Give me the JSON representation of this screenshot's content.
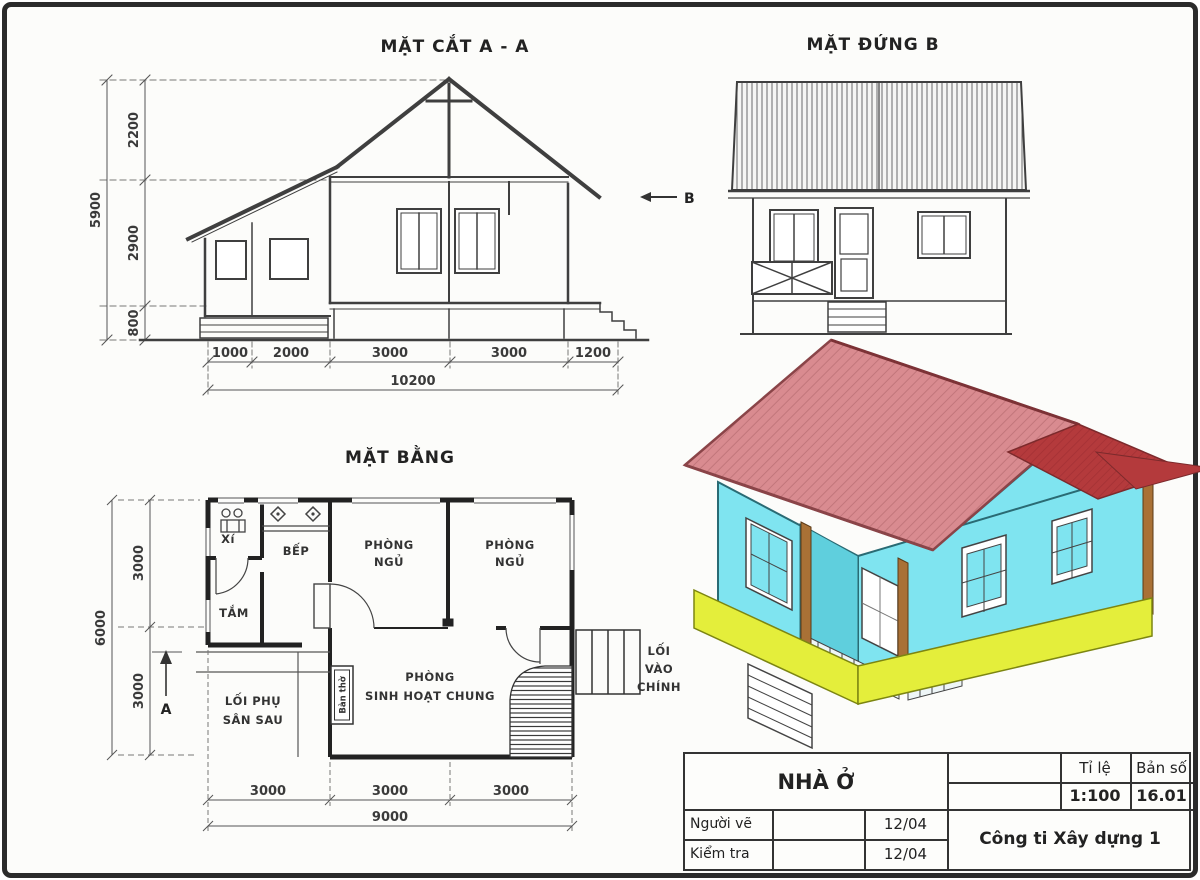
{
  "section": {
    "title": "MẶT CẮT A - A",
    "dim_total_left": "5900",
    "dim_left_segments": [
      "2200",
      "2900",
      "800"
    ],
    "dim_bottom_segments": [
      "1000",
      "2000",
      "3000",
      "3000",
      "1200"
    ],
    "dim_bottom_total": "10200",
    "view_marker": "B"
  },
  "elevation": {
    "title": "MẶT ĐỨNG B"
  },
  "plan": {
    "title": "MẶT BẰNG",
    "room_toilet": "Xí",
    "room_kitchen": "BẾP",
    "room_bedroom1_line1": "PHÒNG",
    "room_bedroom1_line2": "NGỦ",
    "room_bedroom2_line1": "PHÒNG",
    "room_bedroom2_line2": "NGỦ",
    "room_bath": "TẮM",
    "room_living_line1": "PHÒNG",
    "room_living_line2": "SINH HOẠT CHUNG",
    "altar": "Bàn thờ",
    "side_path_line1": "LỐI PHỤ",
    "side_path_line2": "SÂN SAU",
    "entry_line1": "LỐI",
    "entry_line2": "VÀO",
    "entry_line3": "CHÍNH",
    "dim_total_left": "6000",
    "dim_left_segments": [
      "3000",
      "3000"
    ],
    "dim_bottom_segments": [
      "3000",
      "3000",
      "3000"
    ],
    "dim_bottom_total": "9000",
    "section_marker": "A"
  },
  "title_block": {
    "project": "NHÀ Ở",
    "scale_label": "Tỉ lệ",
    "scale_value": "1:100",
    "sheet_label": "Bản số",
    "sheet_value": "16.01",
    "drawn_label": "Người vẽ",
    "drawn_date": "12/04",
    "checked_label": "Kiểm tra",
    "checked_date": "12/04",
    "company": "Công ti Xây dựng 1"
  },
  "colors": {
    "roof_pink": "#d98b90",
    "roof_pink_line": "#c2767b",
    "roof_dark": "#b43a3c",
    "roof_dark_line": "#a23034",
    "wall_cyan": "#7fe4f0",
    "wall_cyan_shade": "#5fcfdd",
    "base_yellow": "#e4ee3b",
    "post_brown": "#a97136",
    "ink": "#3f3f3f"
  }
}
